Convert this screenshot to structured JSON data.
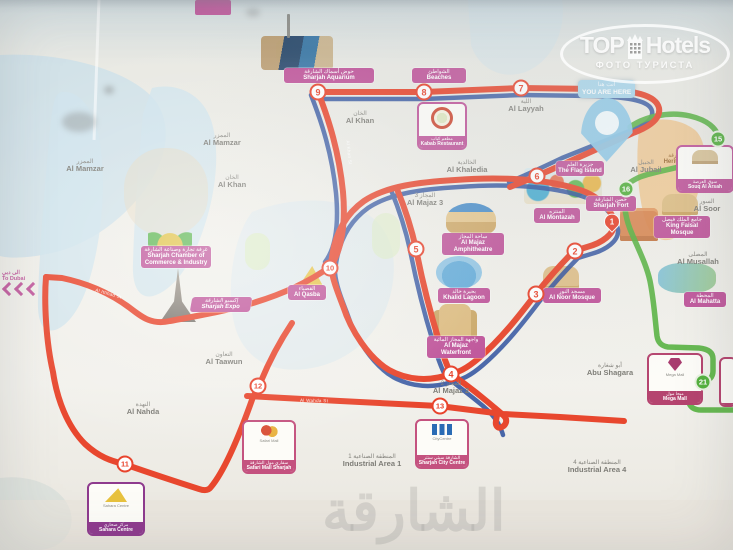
{
  "watermark": {
    "brand_top": "TOP",
    "brand_bottom": "Hotels",
    "subtitle": "ФОТО ТУРИСТА"
  },
  "photo": {
    "bottom_watermark_ar": "الشارقة"
  },
  "you_are_here": {
    "ar": "أنت هنا",
    "en": "YOU ARE HERE"
  },
  "to_dubai": {
    "ar": "الى دبي",
    "en": "To Dubai"
  },
  "colors": {
    "route_red": "#e8472e",
    "route_blue": "#2c4f9e",
    "route_green": "#55b13f",
    "label_pink": "#c0569b",
    "mall_purple": "#8e3a8e",
    "water": "#c9dfe9",
    "heritage_orange": "#f0c387",
    "stop_red": "#e8442d"
  },
  "stops": {
    "red": [
      {
        "n": "7",
        "x": 521,
        "y": 88
      },
      {
        "n": "8",
        "x": 424,
        "y": 92
      },
      {
        "n": "9",
        "x": 318,
        "y": 92
      },
      {
        "n": "6",
        "x": 537,
        "y": 176
      },
      {
        "n": "5",
        "x": 416,
        "y": 249
      },
      {
        "n": "10",
        "x": 330,
        "y": 268
      },
      {
        "n": "2",
        "x": 575,
        "y": 251
      },
      {
        "n": "3",
        "x": 536,
        "y": 294
      },
      {
        "n": "4",
        "x": 451,
        "y": 374
      },
      {
        "n": "13",
        "x": 440,
        "y": 406
      },
      {
        "n": "12",
        "x": 258,
        "y": 386
      },
      {
        "n": "11",
        "x": 125,
        "y": 464
      }
    ],
    "green": [
      {
        "n": "15",
        "x": 718,
        "y": 139
      },
      {
        "n": "16",
        "x": 626,
        "y": 189
      },
      {
        "n": "21",
        "x": 703,
        "y": 382
      }
    ],
    "pin": {
      "n": "1",
      "x": 612,
      "y": 228
    }
  },
  "areas": [
    {
      "ar": "الممزر",
      "en": "Al Mamzar",
      "x": 85,
      "y": 166
    },
    {
      "ar": "الممزر",
      "en": "Al Mamzar",
      "x": 222,
      "y": 140
    },
    {
      "ar": "الخان",
      "en": "Al Khan",
      "x": 232,
      "y": 182
    },
    {
      "ar": "الخان",
      "en": "Al Khan",
      "x": 360,
      "y": 118
    },
    {
      "ar": "اللية",
      "en": "Al Layyah",
      "x": 526,
      "y": 106
    },
    {
      "ar": "الخالدية",
      "en": "Al Khaledia",
      "x": 467,
      "y": 167
    },
    {
      "ar": "المجاز 3",
      "en": "Al Majaz 3",
      "x": 425,
      "y": 200
    },
    {
      "ar": "المجاز 2",
      "en": "Al Majaz 2",
      "x": 451,
      "y": 388
    },
    {
      "ar": "الجبيل",
      "en": "Al Jubail",
      "x": 646,
      "y": 167
    },
    {
      "ar": "أبو شغارة",
      "en": "Abu Shagara",
      "x": 610,
      "y": 370
    },
    {
      "ar": "التعاون",
      "en": "Al Taawun",
      "x": 224,
      "y": 359
    },
    {
      "ar": "النهدة",
      "en": "Al Nahda",
      "x": 143,
      "y": 409
    },
    {
      "ar": "المنطقة الصناعية 1",
      "en": "Industrial Area 1",
      "x": 372,
      "y": 461
    },
    {
      "ar": "المنطقة الصناعية 4",
      "en": "Industrial Area 4",
      "x": 597,
      "y": 467
    },
    {
      "ar": "السور",
      "en": "Al Soor",
      "x": 707,
      "y": 206
    },
    {
      "ar": "المصلى",
      "en": "Al Musallah",
      "x": 698,
      "y": 259
    }
  ],
  "pois": [
    {
      "ar": "حوض أسماك الشارقة",
      "en": "Sharjah Aquarium",
      "x": 284,
      "y": 68,
      "w": 86,
      "style": "pink"
    },
    {
      "ar": "الشواطئ",
      "en": "Beaches",
      "x": 412,
      "y": 68,
      "w": 50,
      "style": "pink"
    },
    {
      "ar": "جزيرة العلم",
      "en": "The Flag Island",
      "x": 556,
      "y": 161,
      "w": 44,
      "style": "pink"
    },
    {
      "ar": "المنتزه",
      "en": "Al Montazah",
      "x": 534,
      "y": 208,
      "w": 42,
      "style": "pink"
    },
    {
      "ar": "حصن الشارقة",
      "en": "Sharjah Fort",
      "x": 586,
      "y": 196,
      "w": 46,
      "style": "pink"
    },
    {
      "ar": "قلب الشارقة",
      "en": "Heritage Area",
      "x": 658,
      "y": 152,
      "w": 46,
      "style": "plain"
    },
    {
      "ar": "غرفة تجارة وصناعة الشارقة",
      "en": "Sharjah Chamber of Commerce & Industry",
      "x": 141,
      "y": 246,
      "w": 66,
      "style": "pink"
    },
    {
      "ar": "إكسبو الشارقة",
      "en": "Sharjah Expo",
      "x": 191,
      "y": 297,
      "w": 56,
      "style": "skew"
    },
    {
      "ar": "القصباء",
      "en": "Al Qasba",
      "x": 288,
      "y": 285,
      "w": 34,
      "style": "pink"
    },
    {
      "ar": "ساحة المجاز",
      "en": "Al Majaz Amphitheatre",
      "x": 442,
      "y": 233,
      "w": 58,
      "style": "pink"
    },
    {
      "ar": "بحيرة خالد",
      "en": "Khalid Lagoon",
      "x": 438,
      "y": 288,
      "w": 48,
      "style": "pink"
    },
    {
      "ar": "واجهة المجاز المائية",
      "en": "Al Majaz Waterfront",
      "x": 427,
      "y": 336,
      "w": 54,
      "style": "pink"
    },
    {
      "ar": "مسجد النور",
      "en": "Al Noor Mosque",
      "x": 543,
      "y": 288,
      "w": 54,
      "style": "pink"
    },
    {
      "ar": "جامع الملك فيصل",
      "en": "King Faisal Mosque",
      "x": 654,
      "y": 216,
      "w": 52,
      "style": "pink"
    },
    {
      "ar": "المحطة",
      "en": "Al Mahatta",
      "x": 684,
      "y": 292,
      "w": 38,
      "style": "pink"
    }
  ],
  "boxes": [
    {
      "name": "kabab-restaurant",
      "ar": "مطعم كباب",
      "en": "Kabab Restaurant",
      "x": 417,
      "y": 102,
      "w": 46,
      "h": 44,
      "color": "#c0569b",
      "logo": "logo-ring",
      "inner": ""
    },
    {
      "name": "souq-al-arsah",
      "ar": "سوق العرصة",
      "en": "Souq Al Arsah",
      "x": 676,
      "y": 145,
      "w": 54,
      "h": 44,
      "color": "#c0569b",
      "logo": "logo-souq",
      "inner": ""
    },
    {
      "name": "mega-mall",
      "ar": "ميجا مول",
      "en": "Mega Mall",
      "x": 647,
      "y": 353,
      "w": 52,
      "h": 48,
      "color": "#b5446f",
      "logo": "logo-gem",
      "inner": "Mega Mall"
    },
    {
      "name": "partial-box",
      "ar": "",
      "en": "",
      "x": 719,
      "y": 357,
      "w": 14,
      "h": 46,
      "color": "#b5446f",
      "logo": "",
      "inner": ""
    },
    {
      "name": "sahara-centre",
      "ar": "مركز صحارى",
      "en": "Sahara Centre",
      "x": 87,
      "y": 482,
      "w": 54,
      "h": 50,
      "color": "#8e3a8e",
      "logo": "logo-tri",
      "inner": "Sahara Centre"
    },
    {
      "name": "safari-mall",
      "ar": "سفاري مول الشارقة",
      "en": "Safari Mall Sharjah",
      "x": 242,
      "y": 420,
      "w": 50,
      "h": 50,
      "color": "#c4527f",
      "logo": "logo-bird",
      "inner": "Safari Mall"
    },
    {
      "name": "sharjah-city-centre",
      "ar": "الشارقة سيتي سنتر",
      "en": "Sharjah City Centre",
      "x": 415,
      "y": 419,
      "w": 50,
      "h": 46,
      "color": "#c4527f",
      "logo": "logo-cc",
      "inner": "CityCentre"
    }
  ],
  "arts": [
    {
      "type": "aquarium",
      "x": 261,
      "y": 36,
      "w": 72,
      "h": 34
    },
    {
      "type": "mast",
      "x": 287,
      "y": 14,
      "w": 3,
      "h": 24
    },
    {
      "type": "waterpark",
      "x": 524,
      "y": 168,
      "w": 78,
      "h": 36
    },
    {
      "type": "chamber",
      "x": 148,
      "y": 226,
      "w": 44,
      "h": 22
    },
    {
      "type": "spire",
      "x": 158,
      "y": 268,
      "w": 40,
      "h": 54
    },
    {
      "type": "boat",
      "x": 299,
      "y": 266,
      "w": 24,
      "h": 20
    },
    {
      "type": "amphi",
      "x": 446,
      "y": 203,
      "w": 50,
      "h": 32
    },
    {
      "type": "fountain",
      "x": 436,
      "y": 256,
      "w": 46,
      "h": 33
    },
    {
      "type": "mosque2",
      "x": 439,
      "y": 304,
      "w": 32,
      "h": 33
    },
    {
      "type": "mosque",
      "x": 543,
      "y": 266,
      "w": 36,
      "h": 23
    },
    {
      "type": "fort",
      "x": 620,
      "y": 208,
      "w": 38,
      "h": 33
    },
    {
      "type": "mosque",
      "x": 662,
      "y": 194,
      "w": 36,
      "h": 21
    },
    {
      "type": "mahatta",
      "x": 658,
      "y": 263,
      "w": 58,
      "h": 30
    }
  ],
  "streets": [
    {
      "t": "Al Wahda St",
      "x": 300,
      "y": 398,
      "rot": 1
    },
    {
      "t": "Al Khan St",
      "x": 337,
      "y": 150,
      "rot": 84
    },
    {
      "t": "Al Ittihad St",
      "x": 95,
      "y": 291,
      "rot": 16
    },
    {
      "t": "Corniche St",
      "x": 592,
      "y": 128,
      "rot": -28
    }
  ]
}
